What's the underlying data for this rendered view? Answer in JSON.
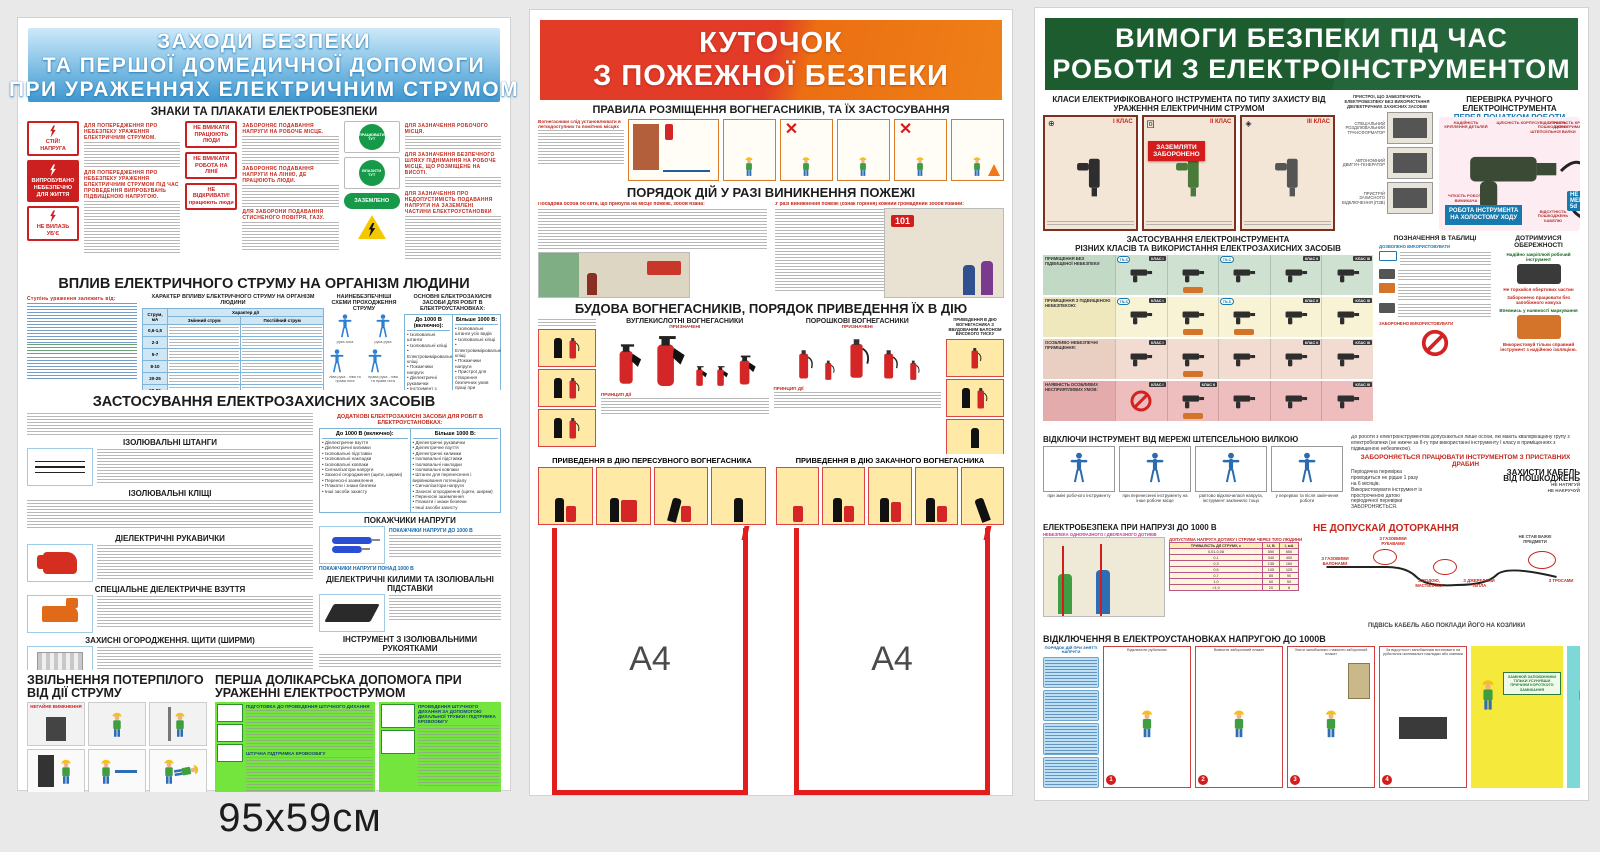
{
  "size_label": "95x59см",
  "colors": {
    "p1_header_blue": "#3c97d0",
    "p2_header_red": "#e23b28",
    "p2_header_orange": "#ee8018",
    "p3_header_green": "#1d5c2f",
    "sign_red": "#cc2020",
    "safety_green": "#169a4a",
    "pocket_red": "#e11d1d",
    "warn_yellow": "#f4c800"
  },
  "p1": {
    "title1": "ЗАХОДИ БЕЗПЕКИ",
    "title2": "ТА ПЕРШОЇ ДОМЕДИЧНОЇ ДОПОМОГИ",
    "title3": "ПРИ УРАЖЕННЯХ ЕЛЕКТРИЧНИМ СТРУМОМ",
    "signs_title": "ЗНАКИ ТА ПЛАКАТИ ЕЛЕКТРОБЕЗПЕКИ",
    "signs": {
      "stop1": "СТІЙ!",
      "stop2": "НАПРУГА",
      "tested1": "ВИПРОБУВАНО",
      "tested2": "НЕБЕЗПЕЧНО",
      "tested3": "ДЛЯ ЖИТТЯ",
      "climb1": "НЕ ВИЛАЗЬ",
      "climb2": "УБ'Є",
      "on1": "НЕ ВМИКАТИ",
      "on1b": "ПРАЦЮЮТЬ ЛЮДИ",
      "on2": "НЕ ВМИКАТИ",
      "on2b": "РОБОТА НА ЛІНІЇ",
      "open1": "НЕ ВІДКРИВАТИ!",
      "open1b": "працюють люди",
      "work_here": "ПРАЦЮВАТИ ТУТ",
      "climb_here": "ВЛАЗИТИ ТУТ",
      "grounded": "ЗАЗЕМЛЕНО"
    },
    "mini_heads": {
      "h1": "ДЛЯ ПОПЕРЕДЖЕННЯ ПРО НЕБЕЗПЕКУ УРАЖЕННЯ ЕЛЕКТРИЧНИМ СТРУМОМ.",
      "h2": "ДЛЯ ПОПЕРЕДЖЕННЯ ПРО НЕБЕЗПЕКУ УРАЖЕННЯ ЕЛЕКТРИЧНИМ СТРУМОМ ПІД ЧАС ПРОВЕДЕННЯ ВИПРОБУВАНЬ ПІДВИЩЕНОЮ НАПРУГОЮ.",
      "h3": "ЗАБОРОНЯЄ ПОДАВАННЯ НАПРУГИ НА РОБОЧЕ МІСЦЕ.",
      "h4": "ЗАБОРОНЯЄ ПОДАВАННЯ НАПРУГИ НА ЛІНІЮ, ДЕ ПРАЦЮЮТЬ ЛЮДИ.",
      "h5": "ДЛЯ ЗАБОРОНИ ПОДАВАННЯ СТИСНЕНОГО ПОВІТРЯ, ГАЗУ.",
      "h6": "ДЛЯ ЗАЗНАЧЕННЯ РОБОЧОГО МІСЦЯ.",
      "h7": "ДЛЯ ЗАЗНАЧЕННЯ БЕЗПЕЧНОГО ШЛЯХУ ПІДНІМАННЯ НА РОБОЧЕ МІСЦЕ, ЩО РОЗМІЩЕНЕ НА ВИСОТІ.",
      "h8": "ДЛЯ ЗАЗНАЧЕННЯ ПРО НЕДОПУСТИМІСТЬ ПОДАВАННЯ НАПРУГИ НА ЗАЗЕМЛЕНІ ЧАСТИНИ ЕЛЕКТРОУСТАНОВКИ"
    },
    "influence": {
      "title": "ВПЛИВ ЕЛЕКТРИЧНОГО СТРУМУ НА ОРГАНІЗМ ЛЮДИНИ",
      "lead": "Ступінь ураження залежить від:",
      "col1_title": "ХАРАКТЕР ВПЛИВУ ЕЛЕКТРИЧНОГО СТРУМУ НА ОРГАНІЗМ ЛЮДИНИ",
      "col2_title": "НАЙНЕБЕЗПЕЧНІШІ СХЕМИ ПРОХОДЖЕННЯ СТРУМУ",
      "col3_title": "ОСНОВНІ ЕЛЕКТРОЗАХИСНІ ЗАСОБИ ДЛЯ РОБІТ В ЕЛЕКТРОУСТАНОВКАХ:",
      "tbl_current": "Струм, мА",
      "tbl_character": "Характер дії",
      "tbl_ac": "Змінний струм",
      "tbl_dc": "Постійний струм",
      "tbl_rows": [
        "0,6-1,5",
        "2-3",
        "5-7",
        "8-10",
        "20-25",
        "50-80"
      ],
      "schemes": [
        "рука-нога",
        "рука-рука",
        "ліва рука - ліва та права нога",
        "права рука - ліва та права нога"
      ],
      "upto": "До 1000 В (включно):",
      "above": "Більше 1000 В:",
      "upto_items": [
        "Ізолювальні штанги",
        "Ізолювальні кліщі",
        "Електровимірювальні кліщі",
        "Покажчики напруги",
        "Діелектричні рукавички",
        "Інструмент з ізоляційним покриттям"
      ],
      "above_items": [
        "Ізолювальні штанги усіх видів",
        "Ізолювальні кліщі",
        "Електровимірювальні кліщі",
        "Покажчики напруги",
        "Пристрої для створення безпечних умов праці при проведенні випробувань і вимірювань в електроустановках (покажчики напруги для фазування, покажчики пошкодження кабелів та ін.)"
      ]
    },
    "apply": {
      "title": "ЗАСТОСУВАННЯ ЕЛЕКТРОЗАХИСНИХ ЗАСОБІВ",
      "sub_rods": "ІЗОЛЮВАЛЬНІ ШТАНГИ",
      "sub_pliers": "ІЗОЛЮВАЛЬНІ КЛІЩІ",
      "sub_indicators": "ПОКАЖЧИКИ НАПРУГИ",
      "ind_upto": "ПОКАЖЧИКИ НАПРУГИ ДО 1000 В",
      "ind_above": "ПОКАЖЧИКИ НАПРУГИ ПОНАД 1000 В",
      "sub_gloves": "ДІЕЛЕКТРИЧНІ РУКАВИЧКИ",
      "sub_boots": "СПЕЦІАЛЬНЕ ДІЕЛЕКТРИЧНЕ ВЗУТТЯ",
      "sub_shields": "ЗАХИСНІ ОГОРОДЖЕННЯ. ЩИТИ (ШИРМИ)",
      "sub_mats": "ДІЕЛЕКТРИЧНІ КИЛИМИ ТА ІЗОЛЮВАЛЬНІ ПІДСТАВКИ",
      "sub_tools": "ІНСТРУМЕНТ З ІЗОЛЮВАЛЬНИМИ РУКОЯТКАМИ",
      "sub_ground": "ПРИСТРОЇ ЗАЗЕМЛЕННЯ",
      "additional_title": "ДОДАТКОВІ ЕЛЕКТРОЗАХИСНІ ЗАСОБИ ДЛЯ РОБІТ В ЕЛЕКТРОУСТАНОВКАХ:",
      "add_upto_items": [
        "Діелектричне взуття",
        "Діелектричні килимки",
        "Ізолювальні підставки",
        "Ізолювальні накладки",
        "Ізолювальні ковпаки",
        "Сигналізатори напруги",
        "Захисні огородження (щити, ширми)",
        "Переносні заземлення",
        "Плакати і знаки безпеки",
        "Інші засоби захисту"
      ],
      "add_above_items": [
        "Діелектричні рукавички",
        "Діелектричне взуття",
        "Діелектричні килимки",
        "Ізолювальні підставки",
        "Ізолювальні накладки",
        "Ізолювальні ковпаки",
        "Штанги для перенесення і вирівнювання потенціалу",
        "Сигналізатори напруги",
        "Захисні огородження (щити, ширми)",
        "Переносні заземлення",
        "Плакати і знаки безпеки",
        "Інші засоби захисту"
      ]
    },
    "rescue_title": "ЗВІЛЬНЕННЯ ПОТЕРПІЛОГО ВІД ДІЇ СТРУМУ",
    "rescue_badge": "НЕГАЙНЕ ВИМКНЕННЯ",
    "aid_title": "ПЕРША ДОЛІКАРСЬКА ДОПОМОГА ПРИ УРАЖЕННІ ЕЛЕКТРОСТРУМОМ",
    "aid_sub1": "ПІДГОТОВКА ДО ПРОВЕДЕННЯ ШТУЧНОГО ДИХАННЯ",
    "aid_sub2": "ШТУЧНА ПІДТРИМКА КРОВООБІГУ",
    "aid_sub3": "ПРОВЕДЕННЯ ШТУЧНОГО ДИХАННЯ ЗА ДОПОМОГОЮ ДИХАЛЬНОЇ ТРУБКИ І ПІДТРИМКА КРОВООБІГУ"
  },
  "p2": {
    "title1": "КУТОЧОК",
    "title2": "З ПОЖЕЖНОЇ БЕЗПЕКИ",
    "s1_title": "ПРАВИЛА РОЗМІЩЕННЯ ВОГНЕГАСНИКІВ, ТА ЇХ ЗАСТОСУВАННЯ",
    "s1_lead": "Вогнегасники слід установлювати в легкодоступних та помітних місцях",
    "s2_title": "ПОРЯДОК ДІЙ У РАЗІ ВИНИКНЕННЯ ПОЖЕЖІ",
    "s2_lead_left": "Посадова особа об'єкта, що прибула на місце пожежі, зобов'язана:",
    "s2_lead_right": "У разі виникнення пожежі (ознак горіння) кожний громадянин зобов'язаний:",
    "s3_title": "БУДОВА ВОГНЕГАСНИКІВ, ПОРЯДОК ПРИВЕДЕННЯ ЇХ В ДІЮ",
    "co2_title": "ВУГЛЕКИСЛОТНІ ВОГНЕГАСНИКИ",
    "powder_title": "ПОРОШКОВІ ВОГНЕГАСНИКИ",
    "designated": "ПРИЗНАЧЕНІ",
    "principle": "ПРИНЦИП ДІЇ",
    "hp_title": "ПРИВЕДЕННЯ В ДІЮ ВОГНЕГАСНИКА З ВБУДОВАНИМ БАЛОНОМ ВИСОКОГО ТИСКУ",
    "mobile_title": "ПРИВЕДЕННЯ В ДІЮ ПЕРЕСУВНОГО ВОГНЕГАСНИКА",
    "pump_title": "ПРИВЕДЕННЯ В ДІЮ ЗАКАЧНОГО ВОГНЕГАСНИКА",
    "emergency": "101",
    "pocket_label": "A4"
  },
  "p3": {
    "title1": "ВИМОГИ БЕЗПЕКИ ПІД ЧАС",
    "title2": "РОБОТИ З ЕЛЕКТРОІНСТРУМЕНТОМ",
    "classes_title": "КЛАСИ ЕЛЕКТРИФІКОВАНОГО ІНСТРУМЕНТА ПО ТИПУ ЗАХИСТУ ВІД УРАЖЕННЯ ЕЛЕКТРИЧНИМ СТРУМОМ",
    "class1": "І КЛАС",
    "class2": "ІІ КЛАС",
    "class3": "ІІІ КЛАС",
    "grounding_badge1": "ЗАЗЕМЛЯТИ",
    "grounding_badge2": "ЗАБОРОНЕНО",
    "devices_title": "ПРИСТРОЇ, ЩО ЗАБЕЗПЕЧУЮТЬ ЕЛЕКТРОБЕЗПЕКУ БЕЗ ВИКОРИСТАННЯ ДІЕЛЕКТРИЧНИХ ЗАХИСНИХ ЗАСОБІВ",
    "device1": "СПЕЦІАЛЬНИЙ РОЗДІЛЮВАЛЬНИЙ ТРАНСФОРМАТОР",
    "device2": "АВТОНОМНИЙ ДВИГУН-ГЕНЕРАТОР",
    "device3": "ПРИСТРІЙ ЗАХИСНОГО ВІДКЛЮЧЕННЯ (ПЗВ)",
    "check_title": "ПЕРЕВІРКА РУЧНОГО ЕЛЕКТРОІНСТРУМЕНТА",
    "check_sub": "ПЕРЕД ПОЧАТКОМ РОБОТИ ПЕРЕВІР:",
    "chk1": "НАДІЙНІСТЬ КРІПЛЕННЯ ДЕТАЛЕЙ",
    "chk2": "ЦІЛІСНІСТЬ КОРПУСУ",
    "chk3": "СПРАВНІСТЬ КРИШОК ЩІТКОТРИМАЧА",
    "chk4": "ВІДСУТНІСТЬ ПОШКОДЖЕНЬ ШТЕПСЕЛЬНОЇ ВИЛКИ",
    "chk5": "ЧІТКІСТЬ РОБОТИ ВИМИКАЧА",
    "chk6": "ВІДСУТНІСТЬ ПОШКОДЖЕНЬ КАБЕЛЮ",
    "d5_note": "НЕ МЕНШЕ",
    "d5": "5d",
    "d": "d",
    "idle_badge1": "РОБОТА ІНСТРУМЕНТА",
    "idle_badge2": "НА ХОЛОСТОМУ ХОДУ",
    "usage_title1": "ЗАСТОСУВАННЯ ЕЛЕКТРОІНСТРУМЕНТА",
    "usage_title2": "РІЗНИХ КЛАСІВ ТА ВИКОРИСТАННЯ ЕЛЕКТРОЗАХИСНИХ ЗАСОБІВ",
    "row1": "ПРИМІЩЕННЯ БЕЗ ПІДВИЩЕНОЇ НЕБЕЗПЕКИ",
    "row2": "ПРИМІЩЕННЯ З ПІДВИЩЕНОЮ НЕБЕЗПЕКОЮ:",
    "row3": "ОСОБЛИВО НЕБЕЗПЕЧНІ ПРИМІЩЕННЯ:",
    "row4": "НАЯВНІСТЬ ОСОБЛИВИХ НЕСПРИЯТЛИВИХ УМОВ:",
    "chip_c1": "КЛАС І",
    "chip_c2": "КЛАС ІІ",
    "chip_c3": "КЛАС ІІІ",
    "tn_s": "TN-S",
    "tn_c": "TN-C",
    "legend_title": "ПОЗНАЧЕННЯ В ТАБЛИЦІ",
    "legend_allowed": "ДОЗВОЛЕНО ВИКОРИСТОВУВАТИ",
    "legend_forbidden": "ЗАБОРОНЕНО ВИКОРИСТОВУВАТИ",
    "caution_title1": "ДОТРИМУЙСЯ",
    "caution_title2": "ОБЕРЕЖНОСТІ",
    "cau1": "Надійно закріплюй робочий інструмент",
    "cau2": "Не торкайся обертових частин",
    "cau3": "Заборонено працювати без запобіжного кожуха",
    "cau4": "Впевнись у наявності маркування",
    "cau5": "Використовуй тільки справний інструмент з надійною ізоляцією.",
    "unplug_title": "ВІДКЛЮЧИ ІНСТРУМЕНТ ВІД МЕРЕЖІ ШТЕПСЕЛЬНОЮ ВИЛКОЮ",
    "unplug_caps": [
      "при зміні робочого інструменту",
      "при перенесенні інструменту на інше робоче місце",
      "раптово відключилася напруга, інструмент заклинило тощо",
      "у перервах та після закінчення роботи"
    ],
    "adm1": "До роботи з електроінструментом допускаються лише особи, які мають кваліфікаційну групу з електробезпеки (не нижче за ІІ-гу при використанні інструменту І класу в приміщеннях з підвищеною небезпекою).",
    "adm2": "Технічне обслуговування, ремонт і періодичну перевірку проводить тільки персонал з групою з електробезпеки не нижче ІІІ-ї.",
    "adm3": "Періодична перевірка проводиться не рідше 1 разу на 6 місяців.",
    "adm4": "Використовувати інструмент із простроченою датою періодичної перевірки ЗАБОРОНЯЄТЬСЯ.",
    "ladders_warning1": "ЗАБОРОНЯЄТЬСЯ ПРАЦЮВАТИ ІНСТРУМЕНТОМ",
    "ladders_warning2": "З ПРИСТАВНИХ ДРАБИН",
    "cable_title1": "ЗАХИСТИ КАБЕЛЬ",
    "cable_title2": "ВІД ПОШКОДЖЕНЬ",
    "cable_no1": "НЕ НАТЯГУЙ",
    "cable_no2": "НЕ НАКРУЧУЙ",
    "lv_title": "ЕЛЕКТРОБЕЗПЕКА ПРИ НАПРУЗІ ДО 1000 В",
    "lv_danger": "НЕБЕЗПЕКА ОДНОФАЗНОГО І ДВОФАЗНОГО ДОТИКІВ",
    "lv_table_title": "ДОПУСТИМА НАПРУГА ДОТИКУ І СТРУМИ ЧЕРЕЗ ТІЛО ЛЮДИНИ",
    "lv_table_sub": "ТРИВАЛІСТЬ ДІЇ СТРУМУ, с",
    "durations": [
      "0,01-0,08",
      "0,1",
      "0,3",
      "0,5",
      "0,7",
      "1,0",
      ">1,0"
    ],
    "u_label": "U, В",
    "u_values": [
      "550",
      "340",
      "135",
      "105",
      "85",
      "60",
      "20"
    ],
    "i_label": "I, мА",
    "i_values": [
      "650",
      "400",
      "160",
      "125",
      "90",
      "50",
      "8"
    ],
    "touch_title": "НЕ ДОПУСКАЙ ДОТОРКАННЯ",
    "touch1": "З ГАЗОВИМИ РУКАВАМИ",
    "touch2": "З ГАЗОВИМИ БАЛОНАМИ",
    "touch3": "З ВОДОЮ, МАСТИЛАМИ",
    "touch4": "З ДЖЕРЕЛАМИ ТЕПЛА",
    "touch5": "З ТРОСАМИ",
    "touch6": "НЕ СТАВ ВАЖКІ ПРЕДМЕТИ",
    "touch7": "ПІДВІСЬ КАБЕЛЬ АБО ПОКЛАДИ ЙОГО НА КОЗЛИКИ",
    "off_title": "ВІДКЛЮЧЕННЯ В ЕЛЕКТРОУСТАНОВКАХ НАПРУГОЮ ДО 1000В",
    "off_sidebar": "ПОРЯДОК ДІЙ ПРИ ЗНЯТТІ НАПРУГИ",
    "step1": "Відключити рубильник",
    "step2": "Вивісити заборонний плакат",
    "step3": "Зняти запобіжники і навісити заборонний плакат",
    "step4": "За відсутності запобіжників встановити на рубильник ізолювальні накладки або ковпаки",
    "fuse_box": "ЗАМІНЮЙ ЗАПОБІЖНИКИ ТІЛЬКИ УСУНУВШИ ПРИЧИНИ КОРОТКОГО ЗАМИКАННЯ",
    "danger_box": "НЕБЕЗПЕЧНО ТРИМАТИСЯ РУКОЮ ЗА ЕЛЕКТРИЧНИЙ ДРІТ",
    "factors_title": "ВРАЖАЮЧІ ФАКТОРИ ТА ЇХ НАСЛІДКИ",
    "rule1": "1. ВІДКЛЮЧИ - ЗНІМИ НАПРУГУ",
    "rule2": "2. ПЕРЕВІР - ВІДСУТНІСТЬ НАПРУГИ",
    "rule3": "3. ВСТАНОВИ - ЗАХИСНЕ ЗАЗЕМЛЕННЯ",
    "hang_poster": "ВИВІСЬ ЗАБОРОННИЙ ПЛАКАТ",
    "connect_title": "ПРАВИЛЬНО ПІДКЛЮЧАЙ І ЗАЗЕМЛЮЙ ЕЛЕКТРОУСТАНОВКИ",
    "scheme_caption": "СХЕМА ЕЛЕКТРОМАГНІТНОГО ОПЕРАТИВНОГО БЛОКУВАННЯ, ЯКА ПОПЕРЕДЖУЄ ВИПАДКОВЕ УВІМКНЕННЯ - ВИМКНЕННЯ"
  }
}
